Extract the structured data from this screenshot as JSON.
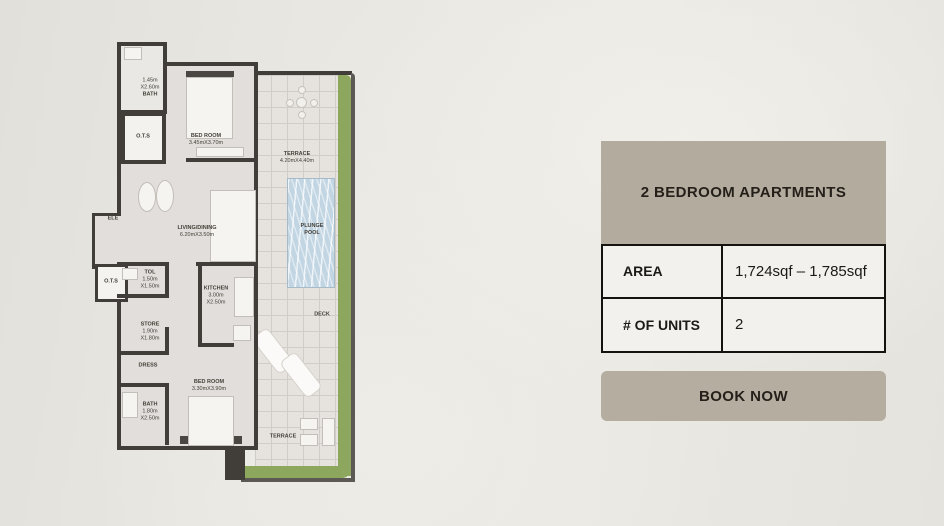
{
  "panel": {
    "title": "2 BEDROOM APARTMENTS",
    "rows": [
      {
        "label": "AREA",
        "value": "1,724sqf – 1,785sqf"
      },
      {
        "label": "# OF UNITS",
        "value": "2"
      }
    ],
    "button_label": "BOOK NOW"
  },
  "floorplan": {
    "rooms": [
      {
        "name": "BATH",
        "dims": "1.45m X2.60m"
      },
      {
        "name": "O.T.S",
        "dims": ""
      },
      {
        "name": "BED ROOM",
        "dims": "3.45mX3.70m"
      },
      {
        "name": "TERRACE",
        "dims": "4.20mX4.40m"
      },
      {
        "name": "ELE",
        "dims": ""
      },
      {
        "name": "LIVING/DINING",
        "dims": "6.20mX3.50m"
      },
      {
        "name": "PLUNGE POOL",
        "dims": ""
      },
      {
        "name": "O.T.S",
        "dims": ""
      },
      {
        "name": "TOL",
        "dims": "1.50m X1.50m"
      },
      {
        "name": "KITCHEN",
        "dims": "3.00m X2.50m"
      },
      {
        "name": "STORE",
        "dims": "1.90m X1.80m"
      },
      {
        "name": "DRESS",
        "dims": ""
      },
      {
        "name": "BED ROOM",
        "dims": "3.30mX3.90m"
      },
      {
        "name": "BATH",
        "dims": "1.80m X2.50m"
      },
      {
        "name": "DECK",
        "dims": ""
      },
      {
        "name": "TERRACE",
        "dims": ""
      }
    ],
    "colors": {
      "wall": "#413E3A",
      "landscape_green": "#8EA75F",
      "pool_blue": "#C1D5E2",
      "panel_taupe": "#B2AB9E"
    }
  }
}
